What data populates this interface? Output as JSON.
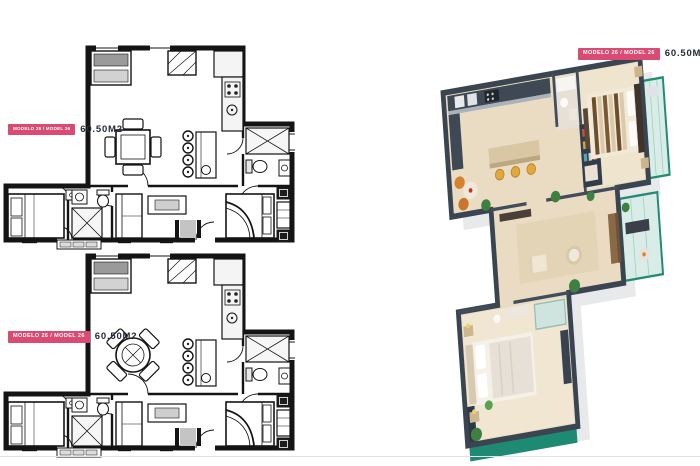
{
  "badges": {
    "plan_top": {
      "model": "MODELO 26 / MODEL 26",
      "area": "60.50M2"
    },
    "plan_bottom": {
      "model": "MODELO 26 / MODEL 26",
      "area": "60.50M2"
    },
    "render": {
      "model": "MODELO 26 / MODEL 26",
      "area": "60.50M2"
    }
  },
  "colors": {
    "badge_pink": "#d94b72",
    "area_text": "#252c37",
    "plan_line": "#141414",
    "wall_dark_3d": "#3b4551",
    "floor_beige_3d": "#e9dcc3",
    "teal_accent_3d": "#1f8a74",
    "glass_teal_3d": "#d9ece7"
  }
}
